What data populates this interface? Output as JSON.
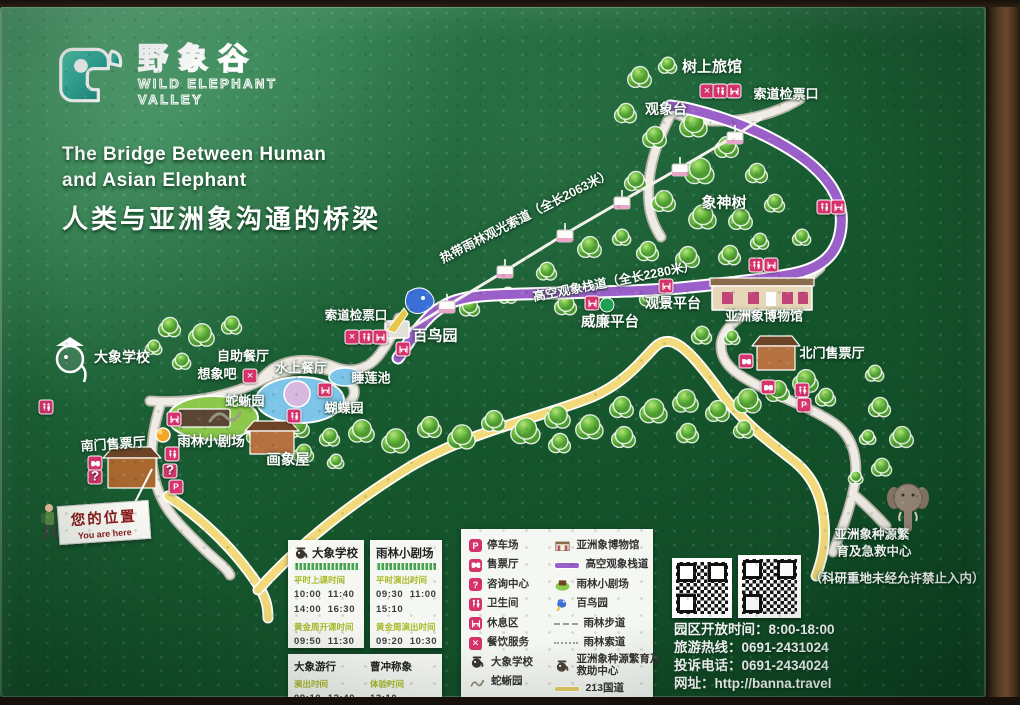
{
  "logo": {
    "cn": "野象谷",
    "en1": "WILD ELEPHANT",
    "en2": "VALLEY"
  },
  "title": {
    "en1": "The Bridge Between Human",
    "en2": "and Asian Elephant",
    "cn": "人类与亚洲象沟通的桥梁"
  },
  "you_are_here": {
    "cn": "您的位置",
    "en": "You are here"
  },
  "colors": {
    "accent_pink": "#d6336c",
    "path_purple": "#9b5fc9",
    "road_yellow": "#f2d979",
    "board_green": "#15552c",
    "logo_teal": "#2fa89a"
  },
  "map": {
    "labels": [
      {
        "id": "tree-hotel",
        "t": "树上旅馆",
        "x": 712,
        "y": 60,
        "fs": 15
      },
      {
        "id": "cable-check-top",
        "t": "索道检票口",
        "x": 786,
        "y": 87,
        "fs": 13
      },
      {
        "id": "observatory",
        "t": "观象台",
        "x": 666,
        "y": 103,
        "fs": 14
      },
      {
        "id": "god-tree",
        "t": "象神树",
        "x": 724,
        "y": 196,
        "fs": 15
      },
      {
        "id": "ropeway",
        "t": "热带雨林观光索道（全长2063米）",
        "x": 525,
        "y": 209,
        "fs": 12.5,
        "r": -27
      },
      {
        "id": "skywalk",
        "t": "高空观象栈道（全长2280米）",
        "x": 614,
        "y": 274,
        "fs": 12.5,
        "r": -11
      },
      {
        "id": "view-platform",
        "t": "观景平台",
        "x": 673,
        "y": 297,
        "fs": 14
      },
      {
        "id": "william-platform",
        "t": "威廉平台",
        "x": 610,
        "y": 315,
        "fs": 14.5
      },
      {
        "id": "museum",
        "t": "亚洲象博物馆",
        "x": 764,
        "y": 309,
        "fs": 13
      },
      {
        "id": "north-ticket-hall",
        "t": "北门售票厅",
        "x": 832,
        "y": 346,
        "fs": 13
      },
      {
        "id": "cable-check-mid",
        "t": "索道检票口",
        "x": 356,
        "y": 308,
        "fs": 12.5
      },
      {
        "id": "bird-garden",
        "t": "百鸟园",
        "x": 435,
        "y": 329,
        "fs": 15
      },
      {
        "id": "buffet",
        "t": "自助餐厅",
        "x": 243,
        "y": 349,
        "fs": 13
      },
      {
        "id": "imagine-bar",
        "t": "想象吧",
        "x": 217,
        "y": 367,
        "fs": 13
      },
      {
        "id": "water-restaurant",
        "t": "水上餐厅",
        "x": 301,
        "y": 361,
        "fs": 13
      },
      {
        "id": "lily-pond",
        "t": "睡莲池",
        "x": 371,
        "y": 371,
        "fs": 13
      },
      {
        "id": "snake-garden",
        "t": "蛇蜥园",
        "x": 245,
        "y": 394,
        "fs": 13
      },
      {
        "id": "butterfly-garden",
        "t": "蝴蝶园",
        "x": 344,
        "y": 401,
        "fs": 13
      },
      {
        "id": "elephant-school",
        "t": "大象学校",
        "x": 122,
        "y": 351,
        "fs": 14
      },
      {
        "id": "south-ticket-hall",
        "t": "南门售票厅",
        "x": 113,
        "y": 437,
        "fs": 13,
        "r": -4
      },
      {
        "id": "rainforest-theater",
        "t": "雨林小剧场",
        "x": 211,
        "y": 434,
        "fs": 13.5
      },
      {
        "id": "paint-house",
        "t": "画象屋",
        "x": 288,
        "y": 453,
        "fs": 14.5
      },
      {
        "id": "rescue-line1",
        "t": "亚洲象种源繁",
        "x": 872,
        "y": 527,
        "fs": 12.5
      },
      {
        "id": "rescue-line2",
        "t": "育及急救中心",
        "x": 874,
        "y": 544,
        "fs": 12.5
      },
      {
        "id": "research-note",
        "t": "（科研重地未经允许禁止入内）",
        "x": 897,
        "y": 571,
        "fs": 12.5
      }
    ],
    "icons": [
      {
        "t": "dining",
        "x": 707,
        "y": 85
      },
      {
        "t": "toilet",
        "x": 720,
        "y": 85
      },
      {
        "t": "rest",
        "x": 734,
        "y": 85
      },
      {
        "t": "toilet",
        "x": 824,
        "y": 201
      },
      {
        "t": "rest",
        "x": 838,
        "y": 201
      },
      {
        "t": "toilet",
        "x": 756,
        "y": 259
      },
      {
        "t": "rest",
        "x": 771,
        "y": 259
      },
      {
        "t": "rest",
        "x": 666,
        "y": 280
      },
      {
        "t": "rest",
        "x": 592,
        "y": 297
      },
      {
        "t": "greendot",
        "x": 607,
        "y": 299
      },
      {
        "t": "dining",
        "x": 352,
        "y": 331
      },
      {
        "t": "toilet",
        "x": 366,
        "y": 331
      },
      {
        "t": "rest",
        "x": 380,
        "y": 331
      },
      {
        "t": "rest",
        "x": 403,
        "y": 343
      },
      {
        "t": "rest",
        "x": 325,
        "y": 384
      },
      {
        "t": "toilet",
        "x": 294,
        "y": 410
      },
      {
        "t": "dining",
        "x": 250,
        "y": 370
      },
      {
        "t": "toilet",
        "x": 46,
        "y": 401
      },
      {
        "t": "rest",
        "x": 174,
        "y": 413
      },
      {
        "t": "toilet",
        "x": 172,
        "y": 448
      },
      {
        "t": "info",
        "x": 170,
        "y": 465
      },
      {
        "t": "parking",
        "x": 176,
        "y": 481
      },
      {
        "t": "ticket",
        "x": 95,
        "y": 457
      },
      {
        "t": "info",
        "x": 95,
        "y": 471
      },
      {
        "t": "ticket",
        "x": 746,
        "y": 355
      },
      {
        "t": "ticket",
        "x": 768,
        "y": 381
      },
      {
        "t": "toilet",
        "x": 802,
        "y": 384
      },
      {
        "t": "parking",
        "x": 804,
        "y": 399
      }
    ]
  },
  "legend": {
    "left": [
      {
        "icon": "parking",
        "label": "停车场"
      },
      {
        "icon": "ticket",
        "label": "售票厅"
      },
      {
        "icon": "info",
        "label": "咨询中心"
      },
      {
        "icon": "toilet",
        "label": "卫生间"
      },
      {
        "icon": "rest",
        "label": "休息区"
      },
      {
        "icon": "dining",
        "label": "餐饮服务"
      },
      {
        "icon": "elephant",
        "label": "大象学校"
      },
      {
        "icon": "snake",
        "label": "蛇蜥园"
      }
    ],
    "right": [
      {
        "icon": "museum",
        "label": "亚洲象博物馆"
      },
      {
        "icon": "line-purple",
        "label": "高空观象栈道"
      },
      {
        "icon": "theater",
        "label": "雨林小剧场"
      },
      {
        "icon": "bird",
        "label": "百鸟园"
      },
      {
        "icon": "line-dashed",
        "label": "雨林步道"
      },
      {
        "icon": "line-dotted",
        "label": "雨林索道"
      },
      {
        "icon": "rescue",
        "label": "亚洲象种源繁育及救助中心"
      },
      {
        "icon": "line-yellow",
        "label": "213国道"
      }
    ]
  },
  "schedules": {
    "school": {
      "title": "大象学校",
      "sections": [
        {
          "head": "平时上课时间",
          "times": [
            "10:00  11:40",
            "14:00  16:30"
          ]
        },
        {
          "head": "黄金周开课时间",
          "times": [
            "09:50  11:30",
            "13:50  15:20",
            "17:00"
          ]
        }
      ]
    },
    "theater": {
      "title": "雨林小剧场",
      "sections": [
        {
          "head": "平时演出时间",
          "times": [
            "09:30  11:00",
            "15:10"
          ]
        },
        {
          "head": "黄金周演出时间",
          "times": [
            "09:20  10:30",
            "12:00  14:20",
            "16:30  17:35"
          ]
        }
      ]
    },
    "extra": [
      {
        "title": "大象游行",
        "head": "演出时间",
        "times": [
          "09:10  13:40"
        ]
      },
      {
        "title": "曹冲称象",
        "head": "体验时间",
        "times": [
          "13:10"
        ]
      }
    ]
  },
  "info": {
    "open": "园区开放时间：8:00-18:00",
    "hotline": "旅游热线：0691-2431024",
    "complaint": "投诉电话：0691-2434024",
    "website": "网址：http://banna.travel"
  }
}
